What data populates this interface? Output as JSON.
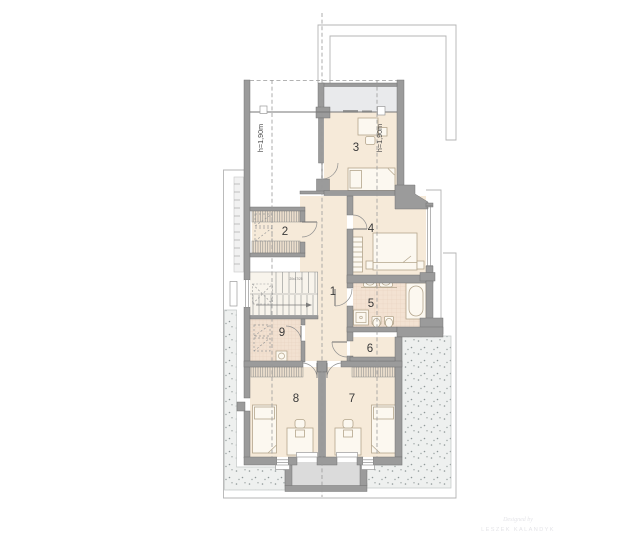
{
  "rooms": {
    "r1": "1",
    "r2": "2",
    "r3": "3",
    "r4": "4",
    "r5": "5",
    "r6": "6",
    "r7": "7",
    "r8": "8",
    "r9": "9"
  },
  "height_lines": {
    "left_label": "h=1,90m",
    "right_label": "h=1,90m"
  },
  "stairs": {
    "dimension_note": "20x17/25"
  },
  "watermark": {
    "line1": "Designed by",
    "line2": "LESZEK KALANDYK"
  },
  "colors": {
    "wall": "#9b9b9b",
    "wall_edge": "#6f6f6f",
    "floor": "#f6ead9",
    "tile_floor": "#f3e2d2",
    "band": "#e9eaec",
    "terrace": "#eef0ef",
    "terrace_dot": "#8f9898",
    "terrace_edge": "#c2c7c6",
    "balcony": "#dbdbdb",
    "outline": "#b4b4b4",
    "dash": "#9a9a9a",
    "furniture_fill": "#fcf8f0",
    "furniture_stroke": "#b3a58c",
    "label": "#3a3a3a",
    "watermark": "#e4e4e8"
  }
}
